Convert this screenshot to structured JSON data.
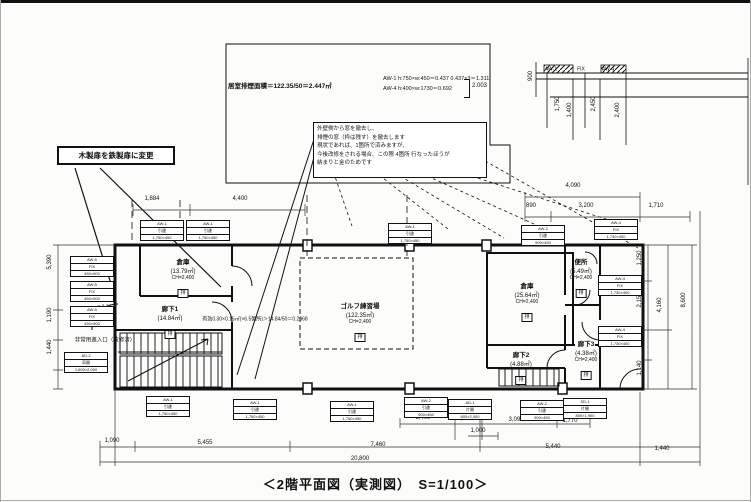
{
  "caption": "＜2階平面図（実測図）　S=1/100＞",
  "notes": {
    "left_callout": "木製扉を鉄製扉に変更",
    "smoke_calc": "居室排煙面積＝122.35/50＝2.447㎡",
    "aw1": "AW-1  h:750×w:450＝0.437   0.437×3＝1.311",
    "aw4": "AW-4  h:400×w:1730＝0.692",
    "aw_total": "2.003",
    "note_box_lines": [
      "外壁側から窓を撤去し、",
      "排煙の窓（枠は残す）を撤去します",
      "現状であれば、1箇所で済みますが、",
      "今後改修をされる場合、この際 4箇所 行なったほうが",
      "納まりと金のためです"
    ]
  },
  "rooms": [
    {
      "name": "倉庫",
      "area": "(13.79㎡)",
      "sub": "CH=2,400",
      "tag": "排",
      "x": 183,
      "y": 256
    },
    {
      "name": "廊下1",
      "area": "(14.84㎡)",
      "sub": "",
      "tag": "排",
      "x": 170,
      "y": 303
    },
    {
      "name": "ゴルフ練習場",
      "area": "(122.35㎡)",
      "sub": "CH=2,400",
      "tag": "排",
      "x": 360,
      "y": 300
    },
    {
      "name": "倉庫",
      "area": "(25.64㎡)",
      "sub": "CH=2,400",
      "tag": "排",
      "x": 527,
      "y": 280
    },
    {
      "name": "便所",
      "area": "(5.49㎡)",
      "sub": "CH=2,400",
      "tag": "排",
      "x": 581,
      "y": 256
    },
    {
      "name": "廊下3",
      "area": "(4.38㎡)",
      "sub": "CH=2,400",
      "tag": "排",
      "x": 586,
      "y": 338
    },
    {
      "name": "廊下2",
      "area": "(4.88㎡)",
      "sub": "",
      "tag": "排",
      "x": 521,
      "y": 349
    }
  ],
  "window_tags": [
    {
      "x": 140,
      "y": 220,
      "rows": [
        "AW-1",
        "引違",
        "1,750×450"
      ]
    },
    {
      "x": 186,
      "y": 220,
      "rows": [
        "AW-1",
        "引違",
        "1,750×450"
      ]
    },
    {
      "x": 388,
      "y": 223,
      "rows": [
        "AW-1",
        "引違",
        "1,750×450"
      ]
    },
    {
      "x": 521,
      "y": 225,
      "rows": [
        "AW-2",
        "引違",
        "900×450"
      ]
    },
    {
      "x": 594,
      "y": 219,
      "rows": [
        "AW-4",
        "FIX",
        "1,730×400"
      ]
    },
    {
      "x": 146,
      "y": 396,
      "rows": [
        "AW-1",
        "引違",
        "1,750×450"
      ]
    },
    {
      "x": 233,
      "y": 399,
      "rows": [
        "AW-1",
        "引違",
        "1,750×450"
      ]
    },
    {
      "x": 330,
      "y": 401,
      "rows": [
        "AW-1",
        "引違",
        "1,750×450"
      ]
    },
    {
      "x": 404,
      "y": 397,
      "rows": [
        "AW-2",
        "引違",
        "900×450"
      ]
    },
    {
      "x": 448,
      "y": 399,
      "rows": [
        "AD-1",
        "片開",
        "800×2,000"
      ]
    },
    {
      "x": 520,
      "y": 400,
      "rows": [
        "AW-2",
        "引違",
        "900×450"
      ]
    },
    {
      "x": 563,
      "y": 398,
      "rows": [
        "SD-1",
        "片開",
        "800×1,900"
      ]
    },
    {
      "x": 70,
      "y": 256,
      "rows": [
        "AW-5",
        "FIX",
        "450×900"
      ]
    },
    {
      "x": 70,
      "y": 281,
      "rows": [
        "AW-5",
        "FIX",
        "450×900"
      ]
    },
    {
      "x": 70,
      "y": 306,
      "rows": [
        "AW-5",
        "FIX",
        "450×900"
      ]
    },
    {
      "x": 64,
      "y": 352,
      "rows": [
        "AD-2",
        "両開",
        "1,600×2,000"
      ]
    },
    {
      "x": 598,
      "y": 275,
      "rows": [
        "AW-4",
        "FIX",
        "1,730×400"
      ]
    },
    {
      "x": 598,
      "y": 326,
      "rows": [
        "AW-4",
        "FIX",
        "1,730×400"
      ]
    }
  ],
  "annotations": [
    {
      "t": "1,884",
      "x": 152,
      "y": 199
    },
    {
      "t": "4,400",
      "x": 240,
      "y": 199
    },
    {
      "t": "4,090",
      "x": 573,
      "y": 186
    },
    {
      "t": "890",
      "x": 531,
      "y": 206
    },
    {
      "t": "3,200",
      "x": 586,
      "y": 206
    },
    {
      "t": "1,710",
      "x": 656,
      "y": 206
    },
    {
      "t": "1,250",
      "x": 640,
      "y": 258,
      "r": 90
    },
    {
      "t": "2,150",
      "x": 640,
      "y": 300,
      "r": 90
    },
    {
      "t": "1,390",
      "x": 640,
      "y": 340,
      "r": 90
    },
    {
      "t": "1,140",
      "x": 640,
      "y": 368,
      "r": 90
    },
    {
      "t": "4,160",
      "x": 660,
      "y": 305,
      "r": 90
    },
    {
      "t": "8,600",
      "x": 684,
      "y": 300,
      "r": 90
    },
    {
      "t": "5,390",
      "x": 50,
      "y": 262,
      "r": 90
    },
    {
      "t": "1,190",
      "x": 50,
      "y": 315,
      "r": 90
    },
    {
      "t": "1,440",
      "x": 50,
      "y": 347,
      "r": 90
    },
    {
      "t": "1,090",
      "x": 112,
      "y": 441
    },
    {
      "t": "5,455",
      "x": 205,
      "y": 443
    },
    {
      "t": "7,460",
      "x": 378,
      "y": 445
    },
    {
      "t": "5,440",
      "x": 553,
      "y": 447
    },
    {
      "t": "1,440",
      "x": 662,
      "y": 449
    },
    {
      "t": "20,800",
      "x": 360,
      "y": 459
    },
    {
      "t": "3,400",
      "x": 423,
      "y": 418
    },
    {
      "t": "1,770",
      "x": 465,
      "y": 419
    },
    {
      "t": "3,090",
      "x": 516,
      "y": 420
    },
    {
      "t": "1,770",
      "x": 570,
      "y": 421
    },
    {
      "t": "1,000",
      "x": 478,
      "y": 431
    },
    {
      "t": "1,750",
      "x": 558,
      "y": 104,
      "r": 90
    },
    {
      "t": "1,400",
      "x": 570,
      "y": 110,
      "r": 90
    },
    {
      "t": "2,450",
      "x": 594,
      "y": 104,
      "r": 90
    },
    {
      "t": "2,400",
      "x": 618,
      "y": 110,
      "r": 90
    },
    {
      "t": "900",
      "x": 531,
      "y": 76,
      "r": 90
    },
    {
      "t": "AW-1",
      "x": 551,
      "y": 70,
      "s": 5
    },
    {
      "t": "FIX",
      "x": 581,
      "y": 70,
      "s": 5
    },
    {
      "t": "AW-4",
      "x": 608,
      "y": 70,
      "s": 5
    },
    {
      "t": "有効0.30×0.15㎡(×6.5箇所)＞14.84/50＝0.2968",
      "x": 255,
      "y": 320,
      "s": 5
    },
    {
      "t": "非常用進入口（改修済）",
      "x": 105,
      "y": 341,
      "s": 5.5
    },
    {
      "t": "▼2.20",
      "x": 104,
      "y": 308,
      "s": 5
    },
    {
      "t": "▲1.10",
      "x": 104,
      "y": 316,
      "s": 5
    }
  ]
}
